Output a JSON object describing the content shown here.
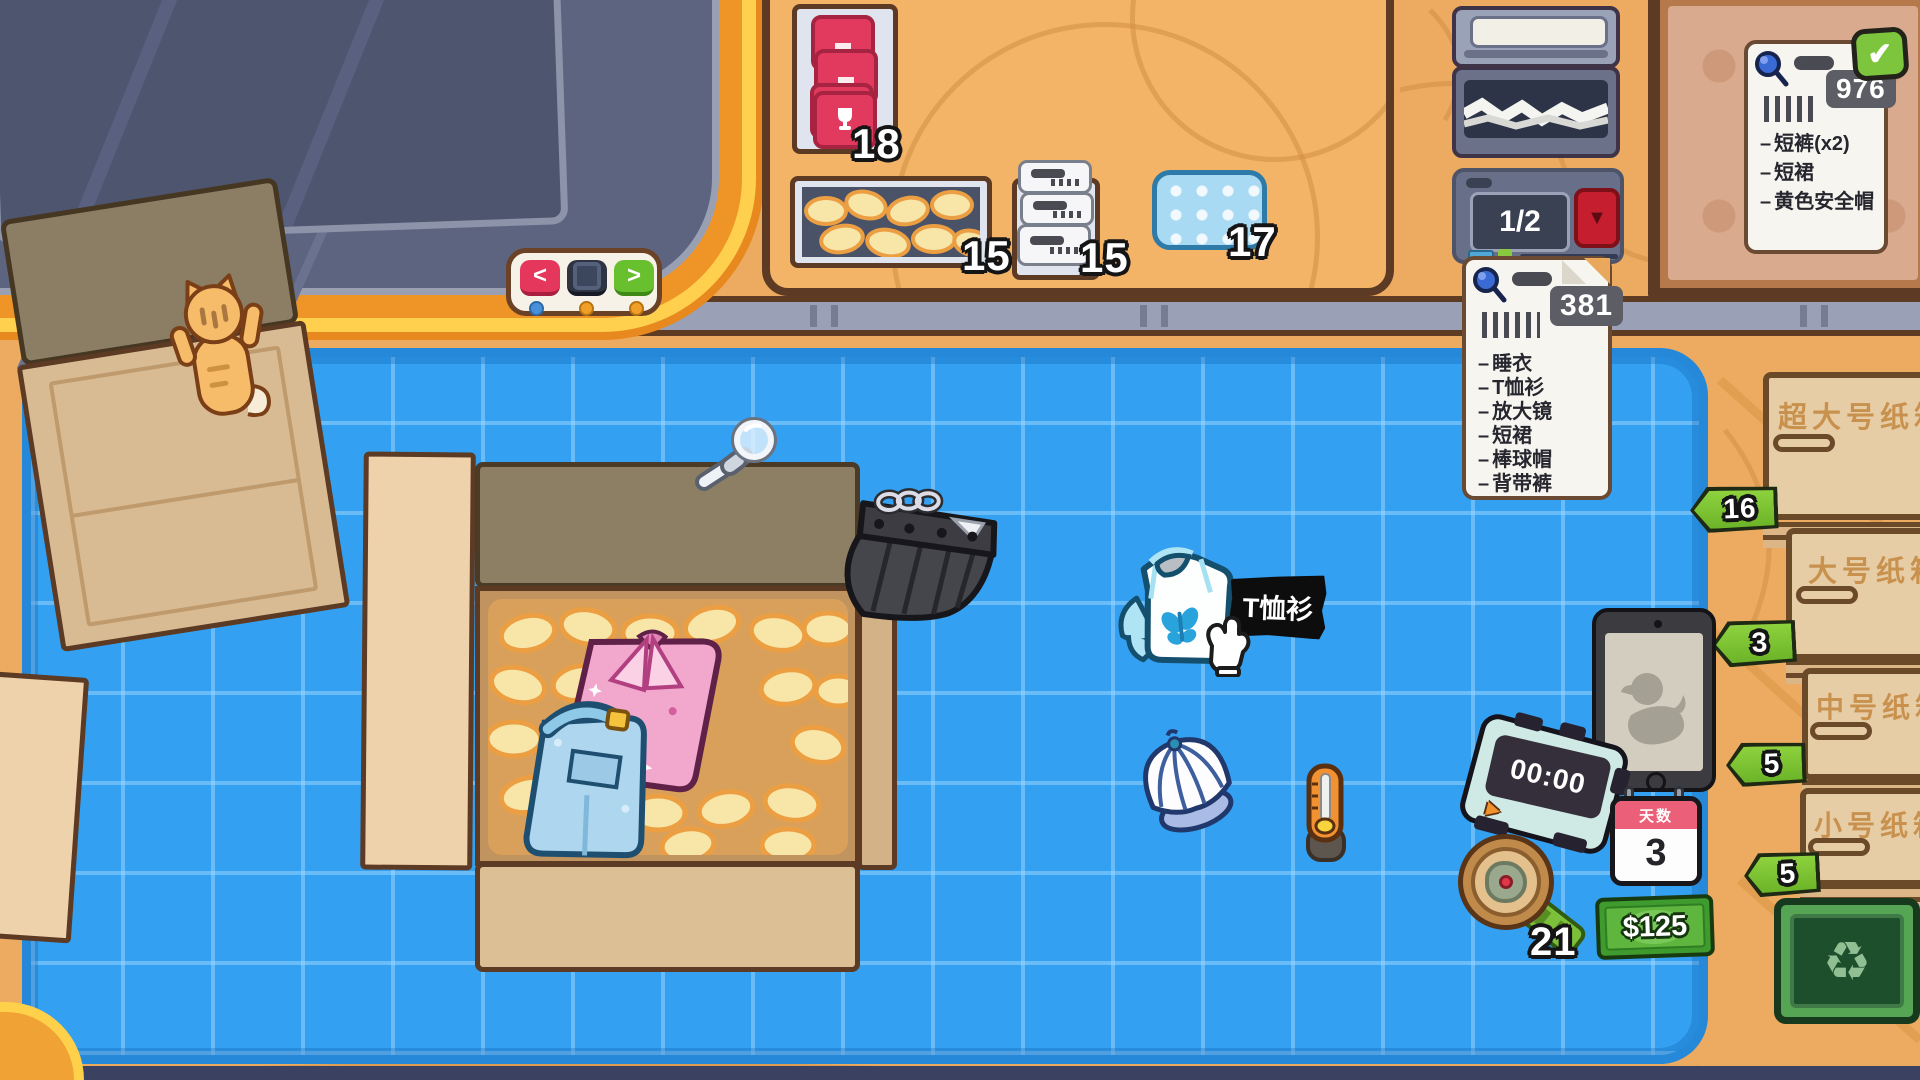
{
  "shelf_supplies": {
    "seal_count": "18",
    "peanut_count": "15",
    "label_count": "15",
    "bubble_count": "17"
  },
  "box_feeder": {
    "display": "1/2",
    "arrow_icon": "▼"
  },
  "nav": {
    "prev": "<",
    "next": ">"
  },
  "order_note": {
    "code": "381",
    "dash": "–",
    "items": [
      "睡衣",
      "T恤衫",
      "放大镜",
      "短裙",
      "棒球帽",
      "背带裤"
    ]
  },
  "done_note": {
    "code": "976",
    "dash": "–",
    "check_icon": "✔",
    "items": [
      "短裤(x2)",
      "短裙",
      "黄色安全帽"
    ]
  },
  "tooltip": {
    "label": "T恤衫"
  },
  "hud": {
    "timer": "00:00",
    "timer_play_icon": "▶",
    "calendar_label": "天数",
    "calendar_day": "3",
    "money": "$125",
    "detector_count": "21"
  },
  "shelf_boxes": {
    "items": [
      {
        "label": "超大号纸箱",
        "count": "16"
      },
      {
        "label": "大号纸箱",
        "count": "3"
      },
      {
        "label": "中号纸箱",
        "count": "5"
      },
      {
        "label": "小号纸箱",
        "count": "5"
      }
    ],
    "recycle_icon": "♻"
  },
  "colors": {
    "mat_blue": "#33a0f2",
    "wood": "#eaa85c",
    "tag_green": "#7dc832",
    "alert_red": "#e5365c",
    "money_green": "#3f9b2e"
  }
}
